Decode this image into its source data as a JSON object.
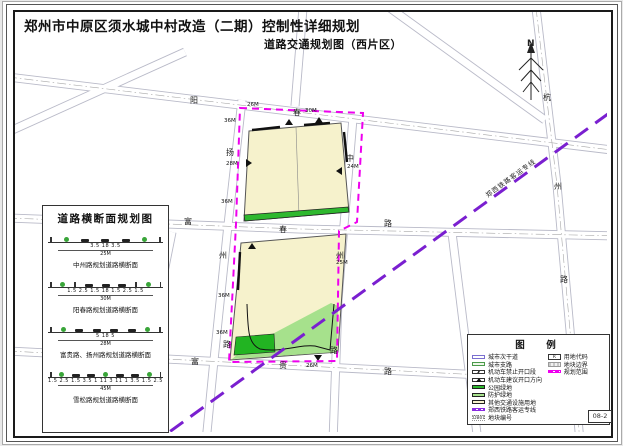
{
  "title": "郑州市中原区须水城中村改造（二期）控制性详细规划",
  "subtitle": "道路交通规划图（西片区）",
  "compass": {
    "north_label": "N"
  },
  "cross_section_panel": {
    "title": "道路横断面规划图",
    "sections": [
      {
        "segments": "3.5        18        3.5",
        "total": "25M",
        "caption": "中州路规划道路横断面"
      },
      {
        "segments": "1.5 2.5 1.5    18    1.5 2.5 1.5",
        "total": "30M",
        "caption": "阳春路规划道路横断面"
      },
      {
        "segments": "5        18        5",
        "total": "28M",
        "caption": "富贵路、扬州路规划道路横断面"
      },
      {
        "segments": "1.5 2.5 1.5 3.5 1  11  3  11  1 3.5 1.5 2.5 1.5",
        "total": "45M",
        "caption": "雪松路规划道路横断面"
      }
    ]
  },
  "map": {
    "railway_label": "郑西铁路客运专线",
    "road_labels": [
      {
        "text": "阳",
        "x": 190,
        "y": 103
      },
      {
        "text": "春",
        "x": 293,
        "y": 115
      },
      {
        "text": "扬",
        "x": 226,
        "y": 155
      },
      {
        "text": "州",
        "x": 219,
        "y": 258
      },
      {
        "text": "路",
        "x": 223,
        "y": 347
      },
      {
        "text": "中",
        "x": 346,
        "y": 161
      },
      {
        "text": "州",
        "x": 336,
        "y": 258
      },
      {
        "text": "路",
        "x": 330,
        "y": 353
      },
      {
        "text": "富",
        "x": 184,
        "y": 224
      },
      {
        "text": "春",
        "x": 279,
        "y": 232
      },
      {
        "text": "路",
        "x": 384,
        "y": 226
      },
      {
        "text": "富",
        "x": 191,
        "y": 364
      },
      {
        "text": "贵",
        "x": 279,
        "y": 368
      },
      {
        "text": "路",
        "x": 384,
        "y": 374
      },
      {
        "text": "杭",
        "x": 543,
        "y": 100
      },
      {
        "text": "州",
        "x": 554,
        "y": 189
      },
      {
        "text": "路",
        "x": 560,
        "y": 282
      }
    ],
    "dim_labels": [
      {
        "text": "26M",
        "x": 247,
        "y": 106
      },
      {
        "text": "30M",
        "x": 305,
        "y": 112
      },
      {
        "text": "36M",
        "x": 224,
        "y": 122
      },
      {
        "text": "28M",
        "x": 226,
        "y": 165
      },
      {
        "text": "36M",
        "x": 221,
        "y": 203
      },
      {
        "text": "36M",
        "x": 218,
        "y": 297
      },
      {
        "text": "36M",
        "x": 216,
        "y": 334
      },
      {
        "text": "24M",
        "x": 347,
        "y": 168
      },
      {
        "text": "25M",
        "x": 336,
        "y": 264
      },
      {
        "text": "26M",
        "x": 306,
        "y": 367
      }
    ]
  },
  "legend": {
    "title": "图　例",
    "left_items": [
      {
        "label": "城市次干道"
      },
      {
        "label": "城市支路"
      },
      {
        "label": "机动车禁止开口段"
      },
      {
        "label": "机动车建议开口方向"
      },
      {
        "label": "公园绿地"
      },
      {
        "label": "防护绿地"
      },
      {
        "label": "其他交通设施用地"
      },
      {
        "label": "郑西铁路客运专线"
      },
      {
        "label": "地块编号",
        "swatch_text": "DB01"
      }
    ],
    "right_items": [
      {
        "label": "用地代码",
        "swatch_text": "R"
      },
      {
        "label": "地块边界"
      },
      {
        "label": "规划范围"
      }
    ]
  },
  "sheet_number": "08-2",
  "colors": {
    "planning_boundary": "#ee00ee",
    "railway": "#7a1fd0",
    "park_green": "#2eb82e",
    "protect_green": "#a6e18c",
    "land_yellow": "#f6f2cc"
  }
}
